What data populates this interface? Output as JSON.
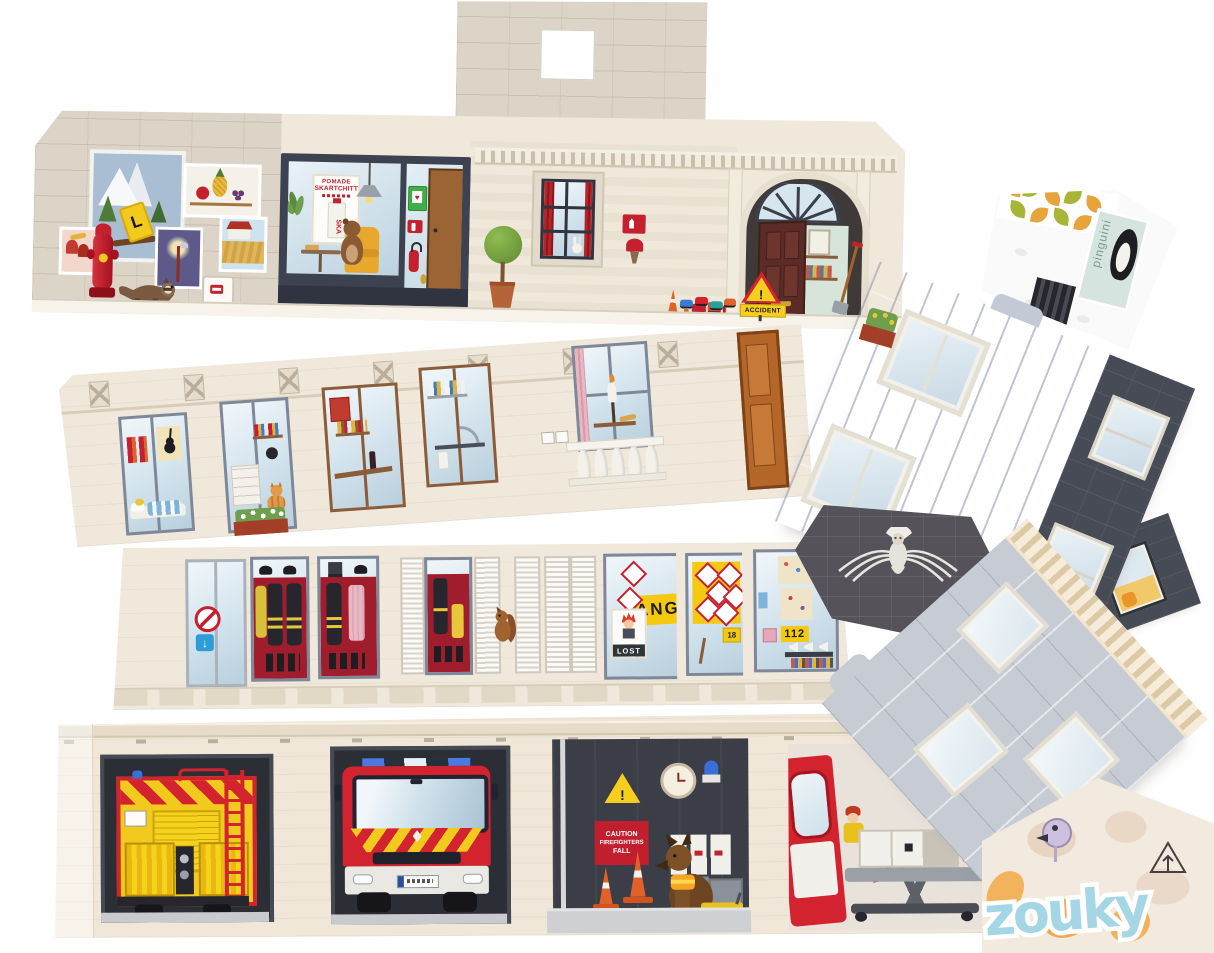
{
  "colors": {
    "background": "#ffffff",
    "facade_cream": "#efe8db",
    "stone_gray": "#dcd4c6",
    "storefront_slate": "#3d4250",
    "accent_red": "#c4202e",
    "accent_yellow": "#f6cf1e",
    "glass_blue": "#d4e4ee",
    "roof_light_gray": "#c3c9d5",
    "slate_dark": "#4a4e59",
    "hex_roof_dark": "#56525a",
    "cone_orange": "#e06228",
    "cornice_tan": "#ead9bc",
    "zouk_blue": "#a5d6e6",
    "graffiti_red": "#c0392b"
  },
  "shop": {
    "poster_line1": "POMADE",
    "poster_line2": "SKARTCHITT",
    "tube_label": "SKA"
  },
  "signs": {
    "accident": "ACCIDENT",
    "danger": "DANGER",
    "lost": "LOST",
    "emergency_number": "112",
    "engine_tag": "18",
    "caution_lines": [
      "CAUTION",
      "FIREFIGHTERS",
      "FALL"
    ]
  },
  "graffiti": {
    "ambulance_wall": "Au Max",
    "zouk": "zouky"
  },
  "labels": {
    "penguin_box": "pinguini"
  },
  "icons": {
    "snowflake": "❄",
    "exclamation": "!",
    "down_arrow": "↓",
    "l_plate": "L",
    "heart": "♥"
  }
}
